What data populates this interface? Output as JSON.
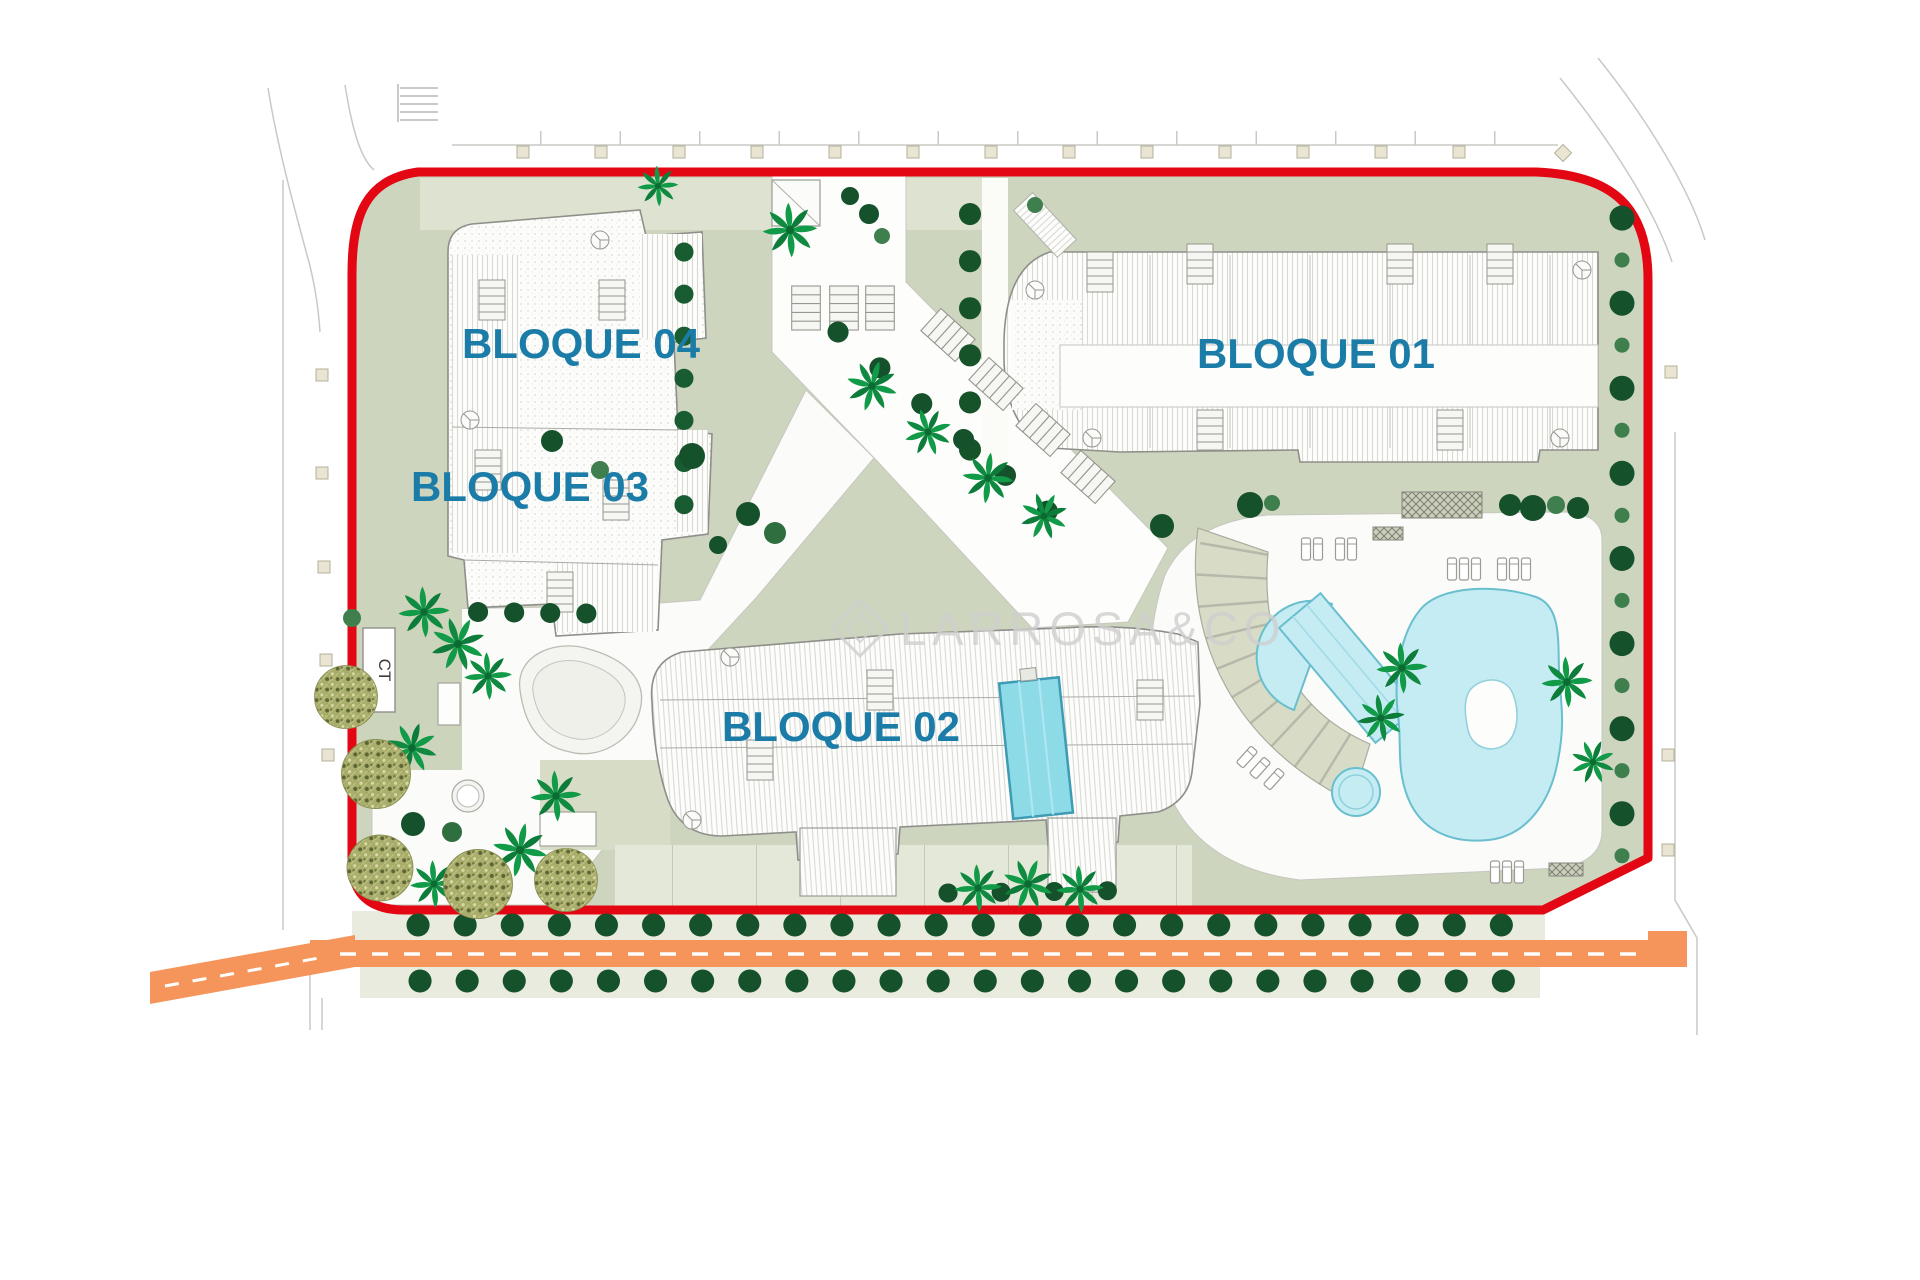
{
  "site_plan": {
    "labels": {
      "bloque_01": "BLOQUE 01",
      "bloque_02": "BLOQUE 02",
      "bloque_03": "BLOQUE 03",
      "bloque_04": "BLOQUE 04",
      "ct": "CT"
    },
    "watermark": {
      "text": "LARROSA&CO"
    },
    "colors": {
      "boundary_red": "#e30613",
      "label_blue": "#1b7ca8",
      "road_orange": "#f5955b",
      "landscape_sage": "#cdd5bf",
      "landscape_sage_light": "#dde3d0",
      "pool_blue": "#c5ebf3",
      "building_pool_blue": "#8edbe8",
      "tree_dark_green": "#15512b",
      "tree_medium_green": "#3f7f4e",
      "palm_green": "#119a47",
      "watermark_gray": "#cfcfcf"
    }
  }
}
